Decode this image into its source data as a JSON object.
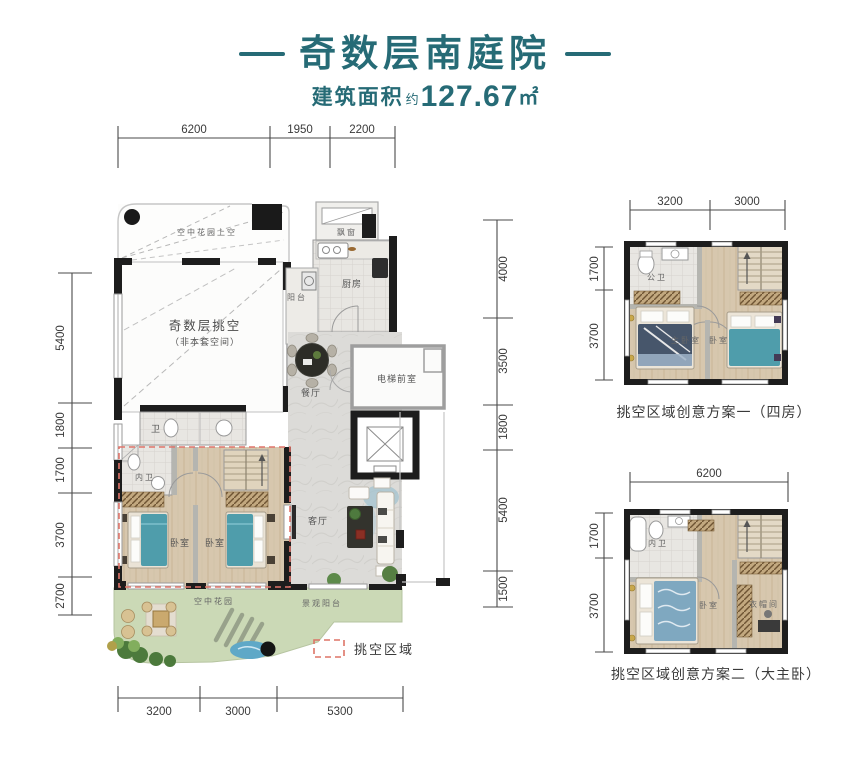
{
  "header": {
    "title": "奇数层南庭院",
    "area_label": "建筑面积",
    "area_approx": "约",
    "area_value": "127.67",
    "area_unit": "㎡"
  },
  "main_plan": {
    "dims_top": [
      "6200",
      "1950",
      "2200"
    ],
    "dims_left": [
      "5400",
      "1800",
      "1700",
      "3700",
      "2700"
    ],
    "dims_right": [
      "4000",
      "3500",
      "1800",
      "5400",
      "1500"
    ],
    "dims_bottom": [
      "3200",
      "3000",
      "5300"
    ],
    "rooms": {
      "sky_garden_above": "空中花园上空",
      "void_label": "奇数层挑空",
      "void_note": "（非本套空间）",
      "bay_window": "飘窗",
      "kitchen": "厨房",
      "balcony": "阳台",
      "dining": "餐厅",
      "elevator_lobby": "电梯前室",
      "bath": "卫",
      "inner_bath": "内卫",
      "bedroom_left": "卧室",
      "bedroom_right": "卧室",
      "living": "客厅",
      "sky_garden": "空中花园",
      "view_balcony": "景观阳台"
    },
    "legend_label": "挑空区域"
  },
  "plan_one": {
    "caption": "挑空区域创意方案一（四房）",
    "dims_top": [
      "3200",
      "3000"
    ],
    "dims_left": [
      "1700",
      "3700"
    ],
    "rooms": {
      "bath": "公卫",
      "master_bedroom": "主卧室",
      "bedroom": "卧室"
    }
  },
  "plan_two": {
    "caption": "挑空区域创意方案二（大主卧）",
    "dims_top": [
      "6200"
    ],
    "dims_left": [
      "1700",
      "3700"
    ],
    "rooms": {
      "inner_bath": "内卫",
      "bedroom": "卧室",
      "closet": "衣帽间"
    }
  },
  "colors": {
    "accent": "#266b76",
    "dim_text": "#3a3a3a",
    "wall": "#1d1d1d",
    "void_red": "#e0756b",
    "bed_teal": "#4f9dab",
    "garden_green": "#cbd9b6"
  }
}
